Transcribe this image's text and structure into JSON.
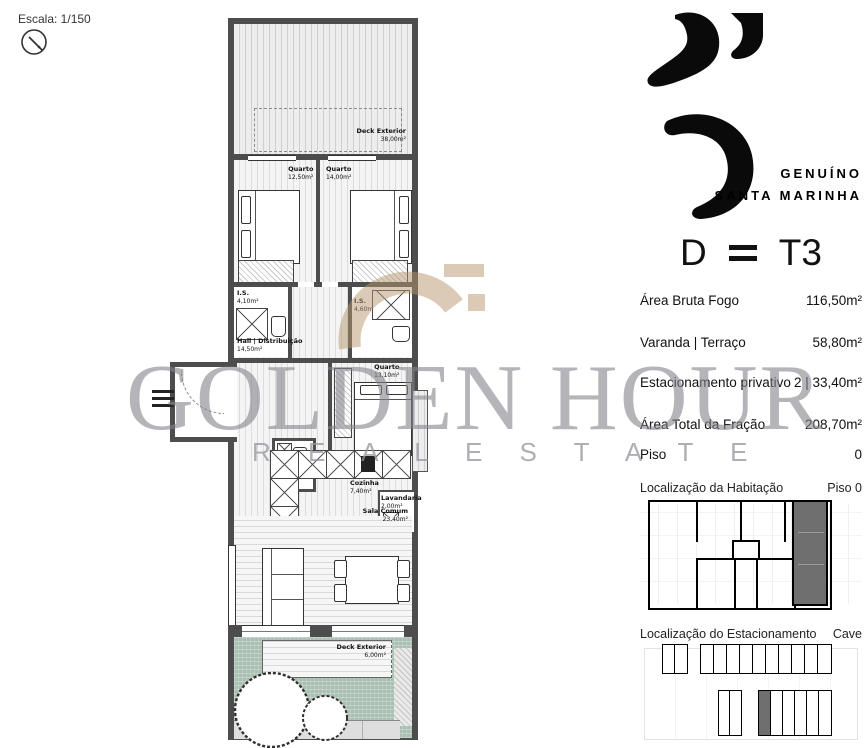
{
  "page": {
    "scale_label": "Escala: 1/150"
  },
  "watermark": {
    "line1": "GOLDEN HOUR",
    "line2": "R E A L   E S T A T E"
  },
  "brand": {
    "line1": "GENUÍNO",
    "line2": "SANTA MARINHA"
  },
  "unit": {
    "letter": "D",
    "typology": "T3"
  },
  "specs": [
    {
      "label": "Área Bruta Fogo",
      "value": "116,50m²"
    },
    {
      "label": "Varanda | Terraço",
      "value": "58,80m²"
    },
    {
      "label": "Estacionamento privativo",
      "value": "2 | 33,40m²"
    },
    {
      "label": "Área Total da Fração",
      "value": "208,70m²"
    },
    {
      "label": "Piso",
      "value": "0"
    }
  ],
  "locators": {
    "habitacao": {
      "title": "Localização da Habitação",
      "tag": "Piso 0"
    },
    "estacionamento": {
      "title": "Localização do Estacionamento",
      "tag": "Cave"
    }
  },
  "rooms": {
    "deck_top": {
      "name": "Deck Exterior",
      "area": "38,00m²"
    },
    "quarto_1": {
      "name": "Quarto",
      "area": "12,50m²"
    },
    "quarto_2": {
      "name": "Quarto",
      "area": "14,00m²"
    },
    "is_1": {
      "name": "I.S.",
      "area": "4,10m²"
    },
    "hall": {
      "name": "Hall | Distribuição",
      "area": "14,50m²"
    },
    "is_2": {
      "name": "I.S.",
      "area": "4,60m²"
    },
    "quarto_3": {
      "name": "Quarto",
      "area": "13,10m²"
    },
    "is_3": {
      "name": "I.S.",
      "area": "1,80m²"
    },
    "cozinha": {
      "name": "Cozinha",
      "area": "7,40m²"
    },
    "lavandaria": {
      "name": "Lavandaria",
      "area": "2,00m²"
    },
    "sala": {
      "name": "Sala Comum",
      "area": "23,40m²"
    },
    "deck_bottom": {
      "name": "Deck Exterior",
      "area": "6,00m²"
    }
  },
  "colors": {
    "wall": "#4d4d4d",
    "unit_highlight": "#6f6f6f",
    "garden_green": "#a9bfb1",
    "watermark_gray": "#83838c",
    "logo_tan": "#b69770",
    "brand_black": "#0a0a0a"
  }
}
